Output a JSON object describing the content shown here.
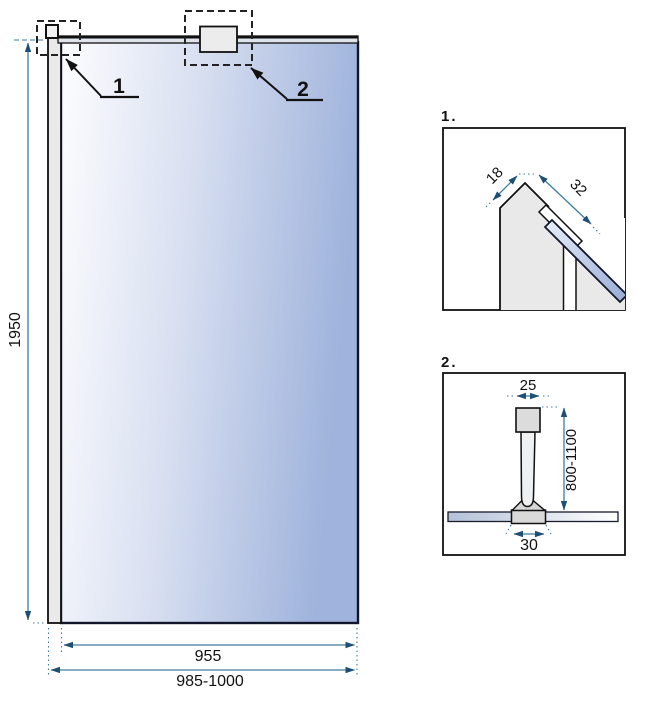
{
  "drawing": {
    "main_view": {
      "callout_1_label": "1",
      "callout_2_label": "2",
      "dim_height": "1950",
      "dim_glass_width": "955",
      "dim_total_width": "985-1000"
    },
    "detail_1": {
      "title": "1.",
      "dim_profile_face": "18",
      "dim_profile_width": "32"
    },
    "detail_2": {
      "title": "2.",
      "dim_arm_width": "25",
      "dim_arm_length": "800-1100",
      "dim_clamp_width": "30"
    }
  },
  "colors": {
    "dimension_line": "#3e7d9e",
    "dimension_arrow": "#1f4f74",
    "outline": "#111111",
    "glass_gradient_light": "#fdfdff",
    "glass_gradient_dark": "#9fb3dc",
    "profile_fill": "#eaeaea",
    "bracket_fill": "#ececec",
    "text": "#111111"
  }
}
